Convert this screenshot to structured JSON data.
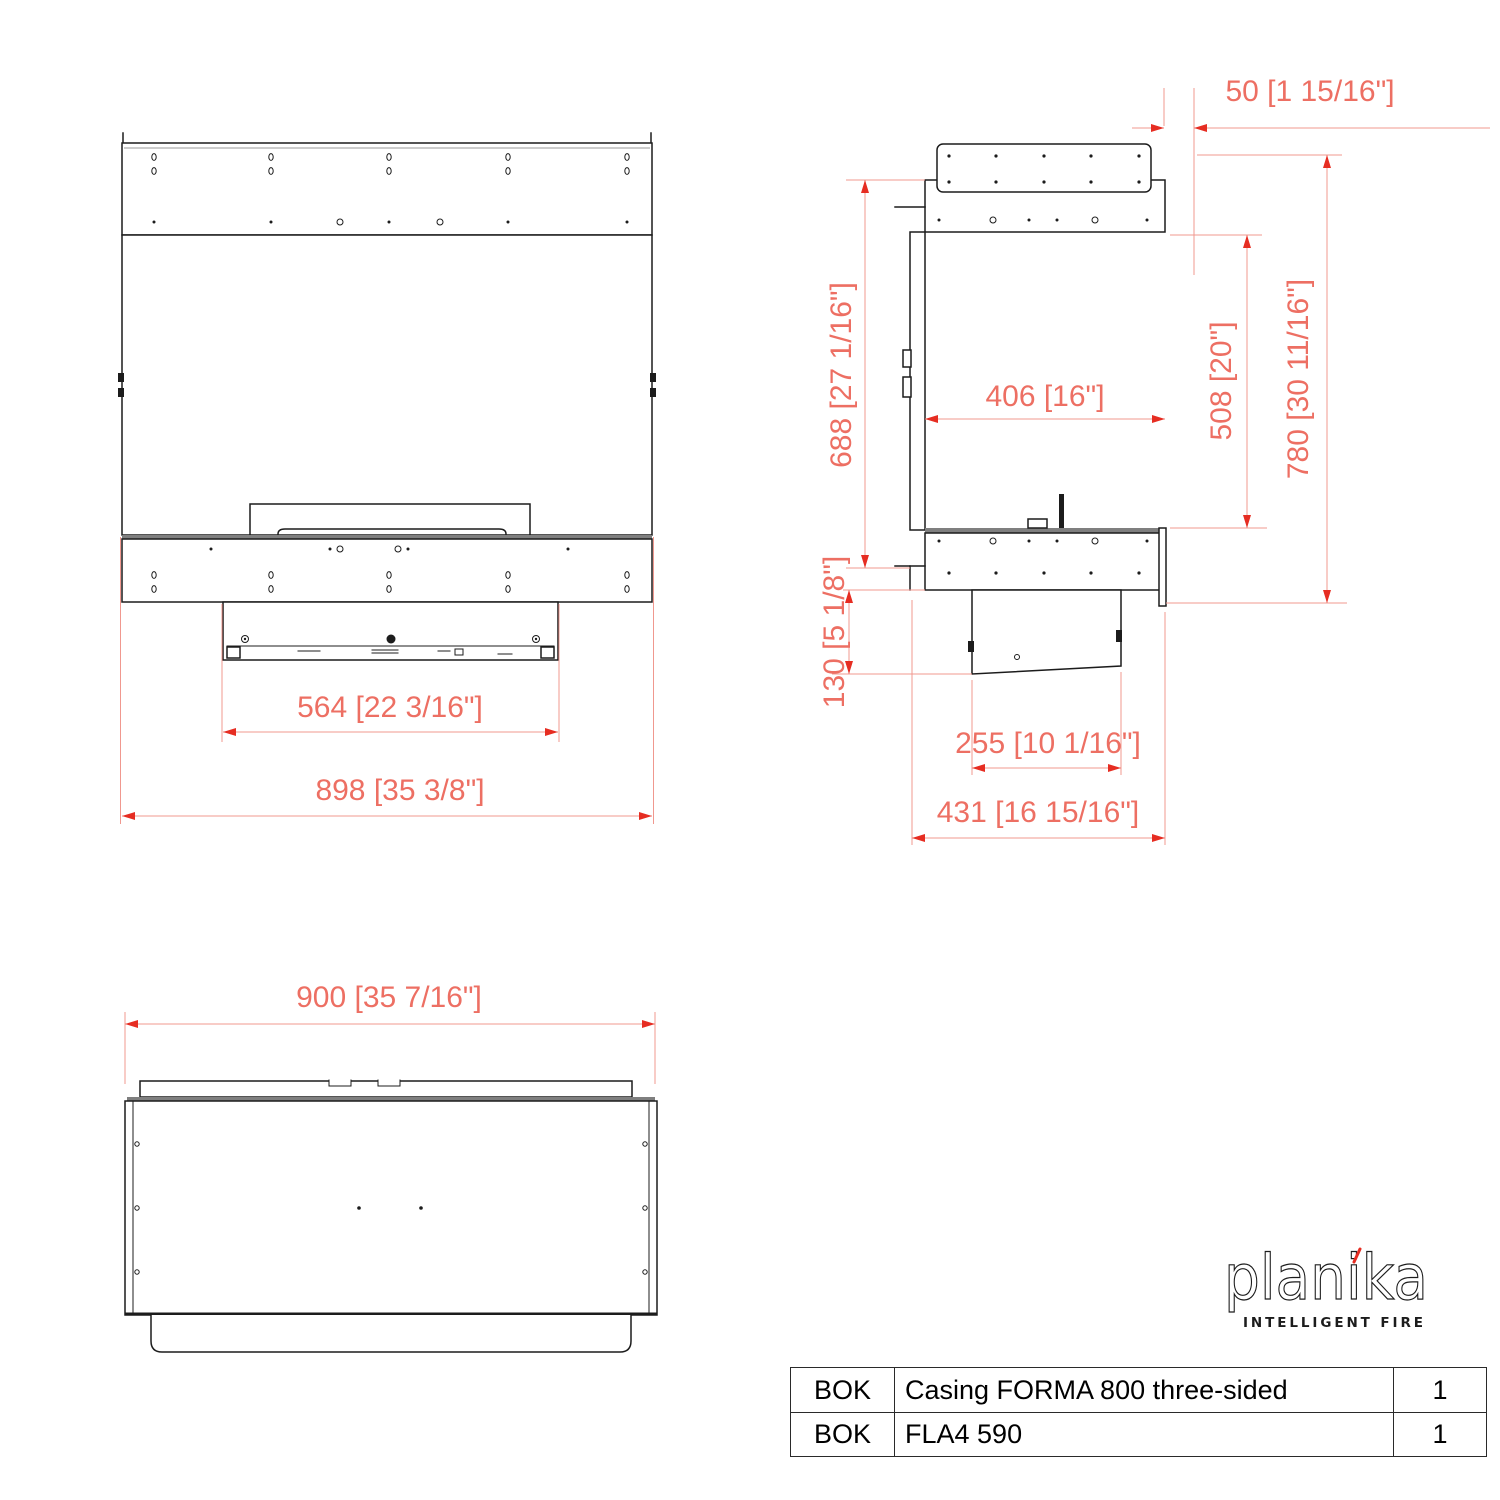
{
  "colors": {
    "line": "#1c1c1c",
    "gray": "#7f7f7f",
    "dim_line": "#f0988f",
    "dim_text": "#ed6f63",
    "arrow": "#e62d22"
  },
  "views": {
    "front": {
      "dims": {
        "burner_width": "564 [22 3/16\"]",
        "overall_width": "898 [35 3/8\"]"
      }
    },
    "side": {
      "dims": {
        "top_offset": "50 [1 15/16\"]",
        "body_height": "688 [27 1/16\"]",
        "opening_depth": "406 [16\"]",
        "opening_height": "508 [20\"]",
        "overall_height": "780 [30 11/16\"]",
        "tray_height": "130 [5 1/8\"]",
        "tray_depth": "255 [10 1/16\"]",
        "overall_depth": "431 [16 15/16\"]"
      }
    },
    "top": {
      "dims": {
        "overall_width": "900 [35 7/16\"]"
      }
    }
  },
  "logo": {
    "brand": "planika",
    "tagline": "INTELLIGENT FIRE"
  },
  "parts_table": {
    "rows": [
      {
        "code": "BOK",
        "description": "Casing FORMA 800 three-sided",
        "qty": "1"
      },
      {
        "code": "BOK",
        "description": "FLA4 590",
        "qty": "1"
      }
    ]
  }
}
